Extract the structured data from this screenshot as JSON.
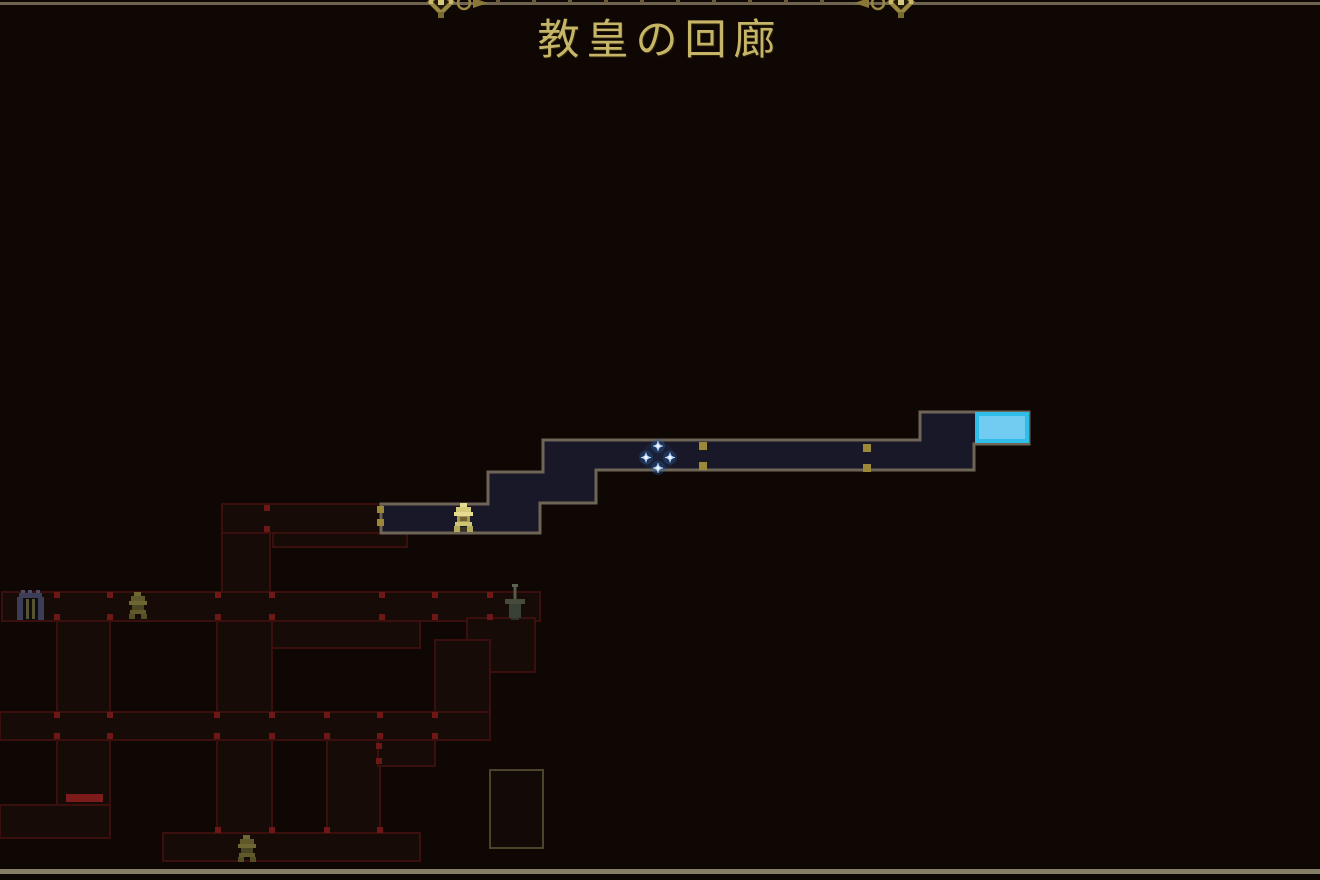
{
  "header": {
    "title": "教皇の回廊",
    "ornament_left": "gold-fleur-flourish",
    "ornament_right": "gold-fleur-flourish"
  },
  "map": {
    "current_room": {
      "marker": "cyan-highlight-rect",
      "x": 977,
      "y": 414,
      "w": 50,
      "h": 27
    },
    "player_marker": {
      "type": "four-sparkle-diamond",
      "x": 658,
      "y": 457
    },
    "icons": [
      {
        "type": "bell-checkpoint",
        "state": "lit",
        "x": 452,
        "y": 503
      },
      {
        "type": "gate-entrance",
        "state": "dim",
        "x": 17,
        "y": 590
      },
      {
        "type": "bell-checkpoint",
        "state": "dim",
        "x": 127,
        "y": 592
      },
      {
        "type": "sword-boss",
        "state": "dim",
        "x": 505,
        "y": 584
      },
      {
        "type": "bell-checkpoint",
        "state": "dim",
        "x": 236,
        "y": 835
      }
    ],
    "doors": {
      "gold_door_pairs": 3,
      "red_door_pairs": 20,
      "sealed_red_bars": 1,
      "unexplored_rooms": 1
    }
  },
  "colors": {
    "background": "#0e0704",
    "bright_room_fill": "#191828",
    "bright_room_border": "#6e6557",
    "dim_room_fill": "#170b08",
    "dim_room_border": "#3b0f0e",
    "door_gold": "#9b8839",
    "door_red": "#6d1717",
    "sealed_red": "#7d1b1b",
    "unexplored_border": "#4c432a",
    "title_gold": "#c6b566",
    "current_room_cyan_border": "#2fbdea",
    "current_room_cyan_fill": "#72ccf2"
  }
}
